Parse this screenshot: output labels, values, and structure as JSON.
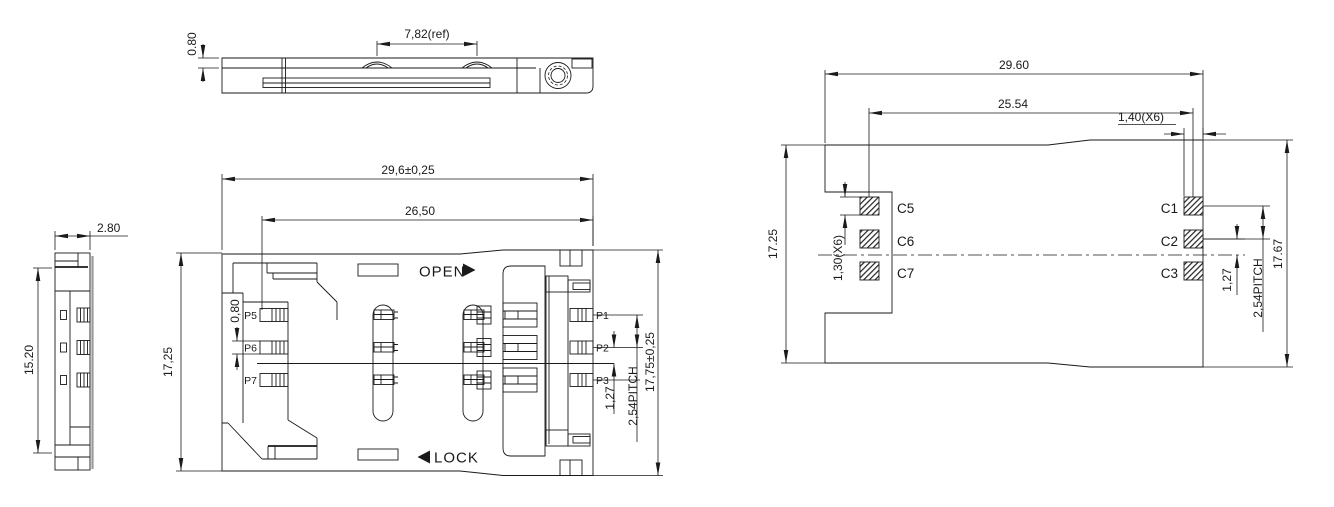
{
  "drawing_title": "SIM card connector engineering drawing",
  "views": {
    "top": {
      "dim_thickness": "0.80",
      "dim_ref": "7,82(ref)"
    },
    "side": {
      "dim_width": "2.80",
      "dim_height": "15.20"
    },
    "main": {
      "dim_overall": "29,6±0,25",
      "dim_body": "26,50",
      "dim_height": "17,25",
      "dim_contact": "0,80",
      "open_label": "OPEN",
      "lock_label": "LOCK",
      "dim_pitch_half": "1,27",
      "dim_pitch": "2,54PITCH",
      "dim_total_height": "17,75±0,25",
      "pins_left": [
        "P5",
        "P6",
        "P7"
      ],
      "pins_right": [
        "P1",
        "P2",
        "P3"
      ]
    },
    "footprint": {
      "dim_overall": "29.60",
      "dim_span": "25.54",
      "dim_pad_width": "1,40(X6)",
      "dim_height_left": "17.25",
      "dim_height_right": "17.67",
      "dim_pad_height": "1,30(X6)",
      "dim_pitch_half": "1,27",
      "dim_pitch": "2,54PITCH",
      "pads_left": [
        "C5",
        "C6",
        "C7"
      ],
      "pads_right": [
        "C1",
        "C2",
        "C3"
      ]
    }
  }
}
